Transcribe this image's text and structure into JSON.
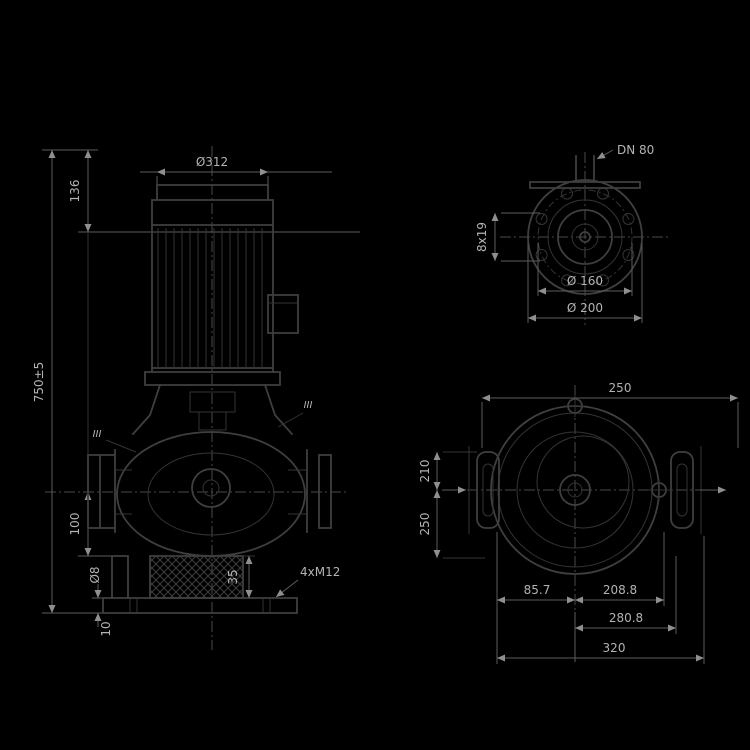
{
  "front": {
    "motor_diameter": "Ø312",
    "height_top": "136",
    "height_total": "750±5",
    "port_height": "100",
    "drain": "Ø8",
    "plate_thickness": "10",
    "foot_height": "35",
    "anchor_bolts": "4xM12",
    "section_left": "III",
    "section_right": "III"
  },
  "flange": {
    "nominal": "DN 80",
    "holes": "8x19",
    "bolt_circle": "Ø 160",
    "outer_diameter": "Ø 200"
  },
  "plan": {
    "width_right": "250",
    "height_upper": "210",
    "height_lower": "250",
    "offset_left": "85.7",
    "offset_right": "208.8",
    "width_inner": "280.8",
    "width_total": "320"
  },
  "colors": {
    "background": "#000000",
    "line": "#3f3f3f",
    "line_thin": "#343434",
    "dim": "#5c5c5c",
    "centerline": "#4a4a4a",
    "text": "#b3b3b3"
  }
}
